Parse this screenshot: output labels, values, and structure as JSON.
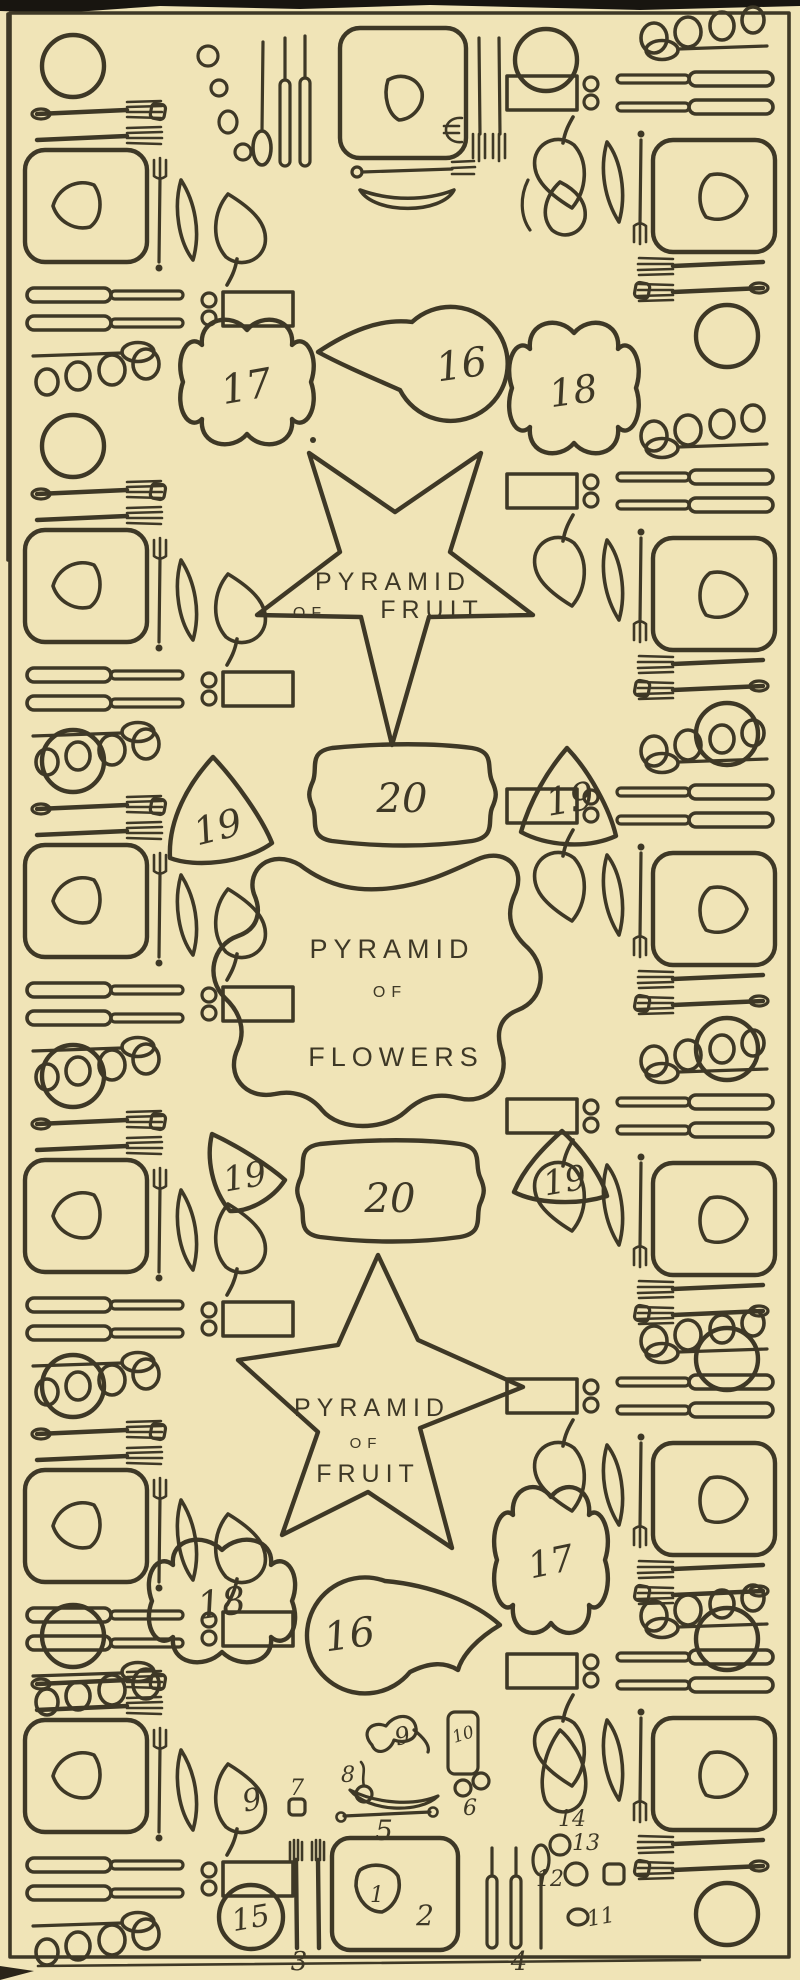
{
  "figure": {
    "kind": "banquet table setting plan",
    "paper_color": "#f0e4b7",
    "ink_color": "#3e3826"
  },
  "centerpieces": [
    {
      "id": "top-star",
      "line1": "PYRAMID",
      "line2": "OF",
      "line3": "FRUIT"
    },
    {
      "id": "flowers",
      "line1": "PYRAMID",
      "line2": "OF",
      "line3": "FLOWERS"
    },
    {
      "id": "bottom-star",
      "line1": "PYRAMID",
      "line2": "OF",
      "line3": "FRUIT"
    }
  ],
  "markers": {
    "top": [
      "17",
      "16",
      "18"
    ],
    "upper_row": [
      "19",
      "20",
      "19"
    ],
    "lower_row": [
      "19",
      "20",
      "19"
    ],
    "bottom": [
      "18",
      "16",
      "17"
    ]
  },
  "legend": {
    "numbers": [
      "1",
      "2",
      "3",
      "4",
      "5",
      "6",
      "7",
      "8",
      "9",
      "10",
      "11",
      "12",
      "13",
      "14",
      "15"
    ]
  }
}
